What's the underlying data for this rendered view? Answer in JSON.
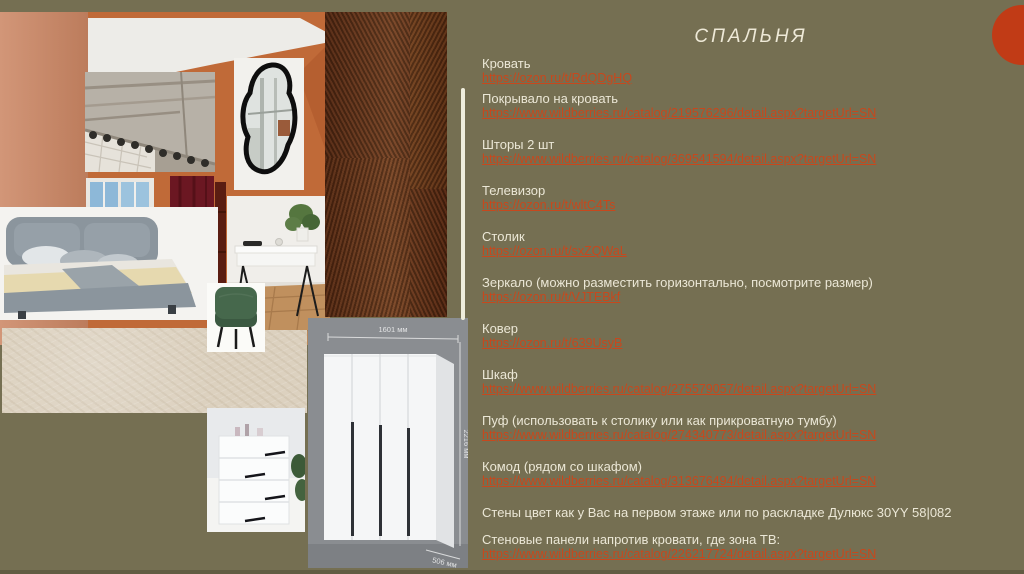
{
  "slide": {
    "title": "СПАЛЬНЯ",
    "background_color": "#756f52",
    "text_color": "#ebe7d6",
    "link_color": "#c7481d",
    "accent_circle_color": "#c13b16"
  },
  "items": [
    {
      "label": "Кровать",
      "link": "https://ozon.ru/t/RdQDgHQ"
    },
    {
      "label": "Покрывало на кровать",
      "link": "https://www.wildberries.ru/catalog/219576296/detail.aspx?targetUrl=SN"
    },
    {
      "label": "Шторы 2 шт",
      "link": "https://www.wildberries.ru/catalog/369541594/detail.aspx?targetUrl=SN"
    },
    {
      "label": "Телевизор",
      "link": "https://ozon.ru/t/wltC4Ts"
    },
    {
      "label": "Столик",
      "link": "https://ozon.ru/t/sxZQWaL"
    },
    {
      "label": "Зеркало (можно разместить горизонтально, посмотрите размер)",
      "link": "https://ozon.ru/t/VJTEBkf"
    },
    {
      "label": "Ковер",
      "link": "https://ozon.ru/t/639UsyB"
    },
    {
      "label": "Шкаф",
      "link": "https://www.wildberries.ru/catalog/275579057/detail.aspx?targetUrl=SN"
    },
    {
      "label": "Пуф (использовать к столику или как прикроватную тумбу)",
      "link": "https://www.wildberries.ru/catalog/274340773/detail.aspx?targetUrl=SN"
    },
    {
      "label": "Комод (рядом со шкафом)",
      "link": "https://www.wildberries.ru/catalog/313676494/detail.aspx?targetUrl=SN"
    },
    {
      "label": "Стены цвет как у Вас на первом этаже или по раскладке Дулюкс 30YY 58|082",
      "link": null
    },
    {
      "label": "Стеновые панели напротив кровати, где зона ТВ:",
      "link": "https://www.wildberries.ru/catalog/226217724/detail.aspx?targetUrl=SN"
    }
  ],
  "moodboard": {
    "images": [
      "room-reference-photo",
      "wood-panel-texture",
      "roman-blind-photo",
      "organic-mirror-photo",
      "bed-photo",
      "dressing-table-photo",
      "green-pouf-photo",
      "carpet-swatch",
      "chest-of-drawers-photo",
      "wardrobe-render"
    ],
    "wardrobe_dimensions": {
      "width": "1601 мм",
      "height": "2216 мм",
      "depth": "506 мм"
    }
  }
}
